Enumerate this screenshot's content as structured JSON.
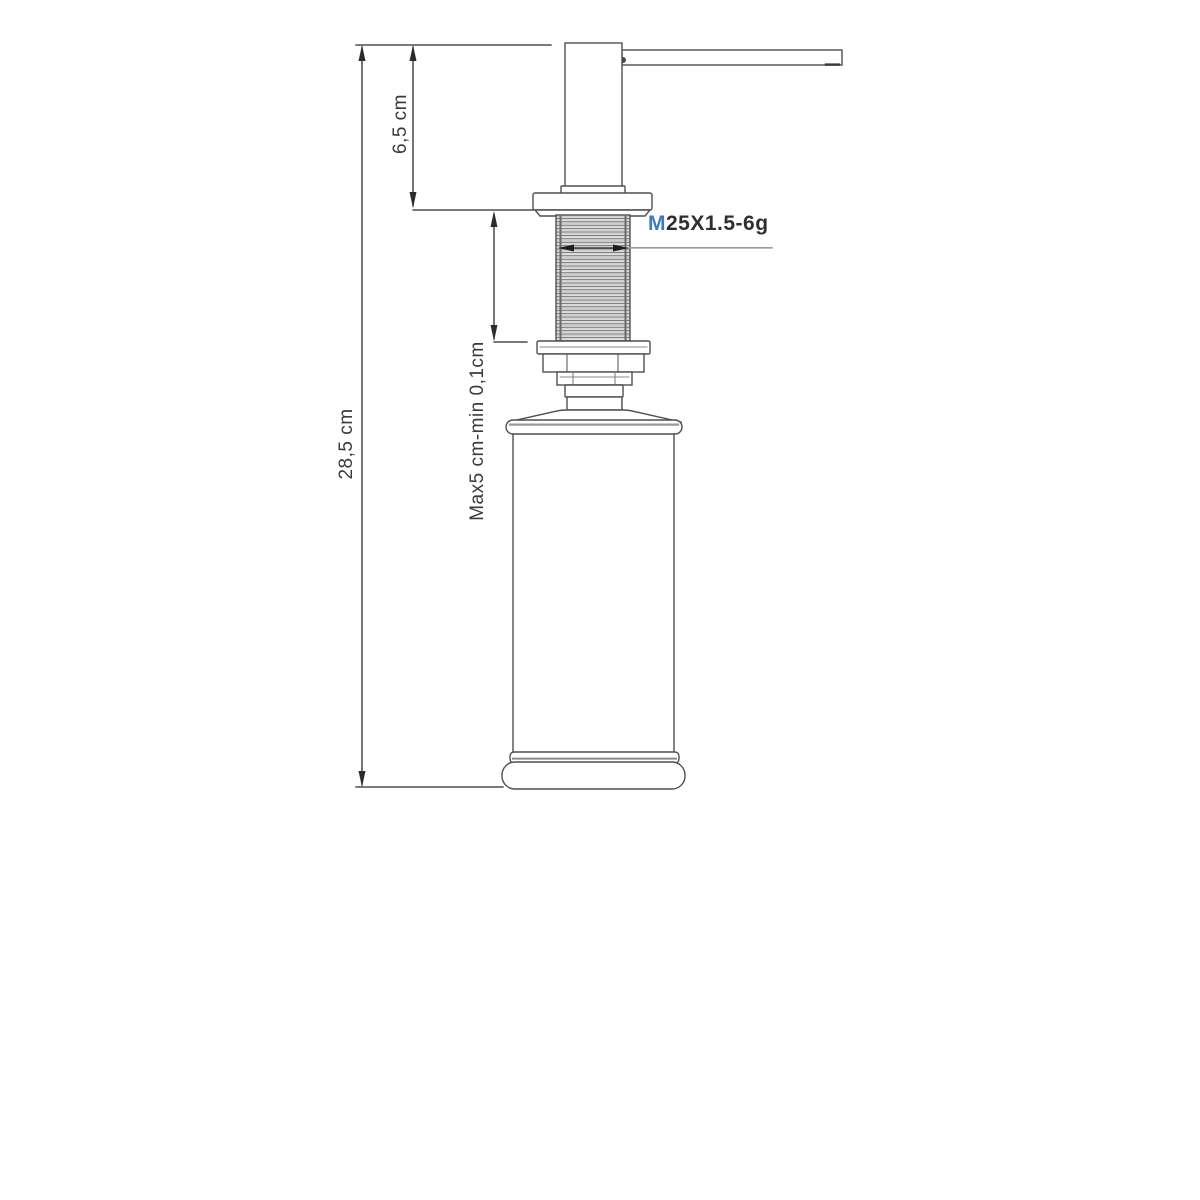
{
  "page": {
    "title": "Soap dispenser dimension drawing"
  },
  "drawing": {
    "type": "technical-dimension-diagram",
    "subject": "counter-mounted soap dispenser side view",
    "labels": {
      "overall_height": "28,5 cm",
      "above_counter_height": "6,5 cm",
      "counter_thickness_range": "Max5 cm-min 0,1cm",
      "thread_spec": "M25X1.5-6g"
    },
    "colors": {
      "background": "#ffffff",
      "outline": "#4f4f4f",
      "dimension_line": "#2b2b2b",
      "leader_line": "#9a9a9a",
      "label_text": "#3c3a40",
      "thread_spec_accent": "#3f77c8"
    }
  }
}
